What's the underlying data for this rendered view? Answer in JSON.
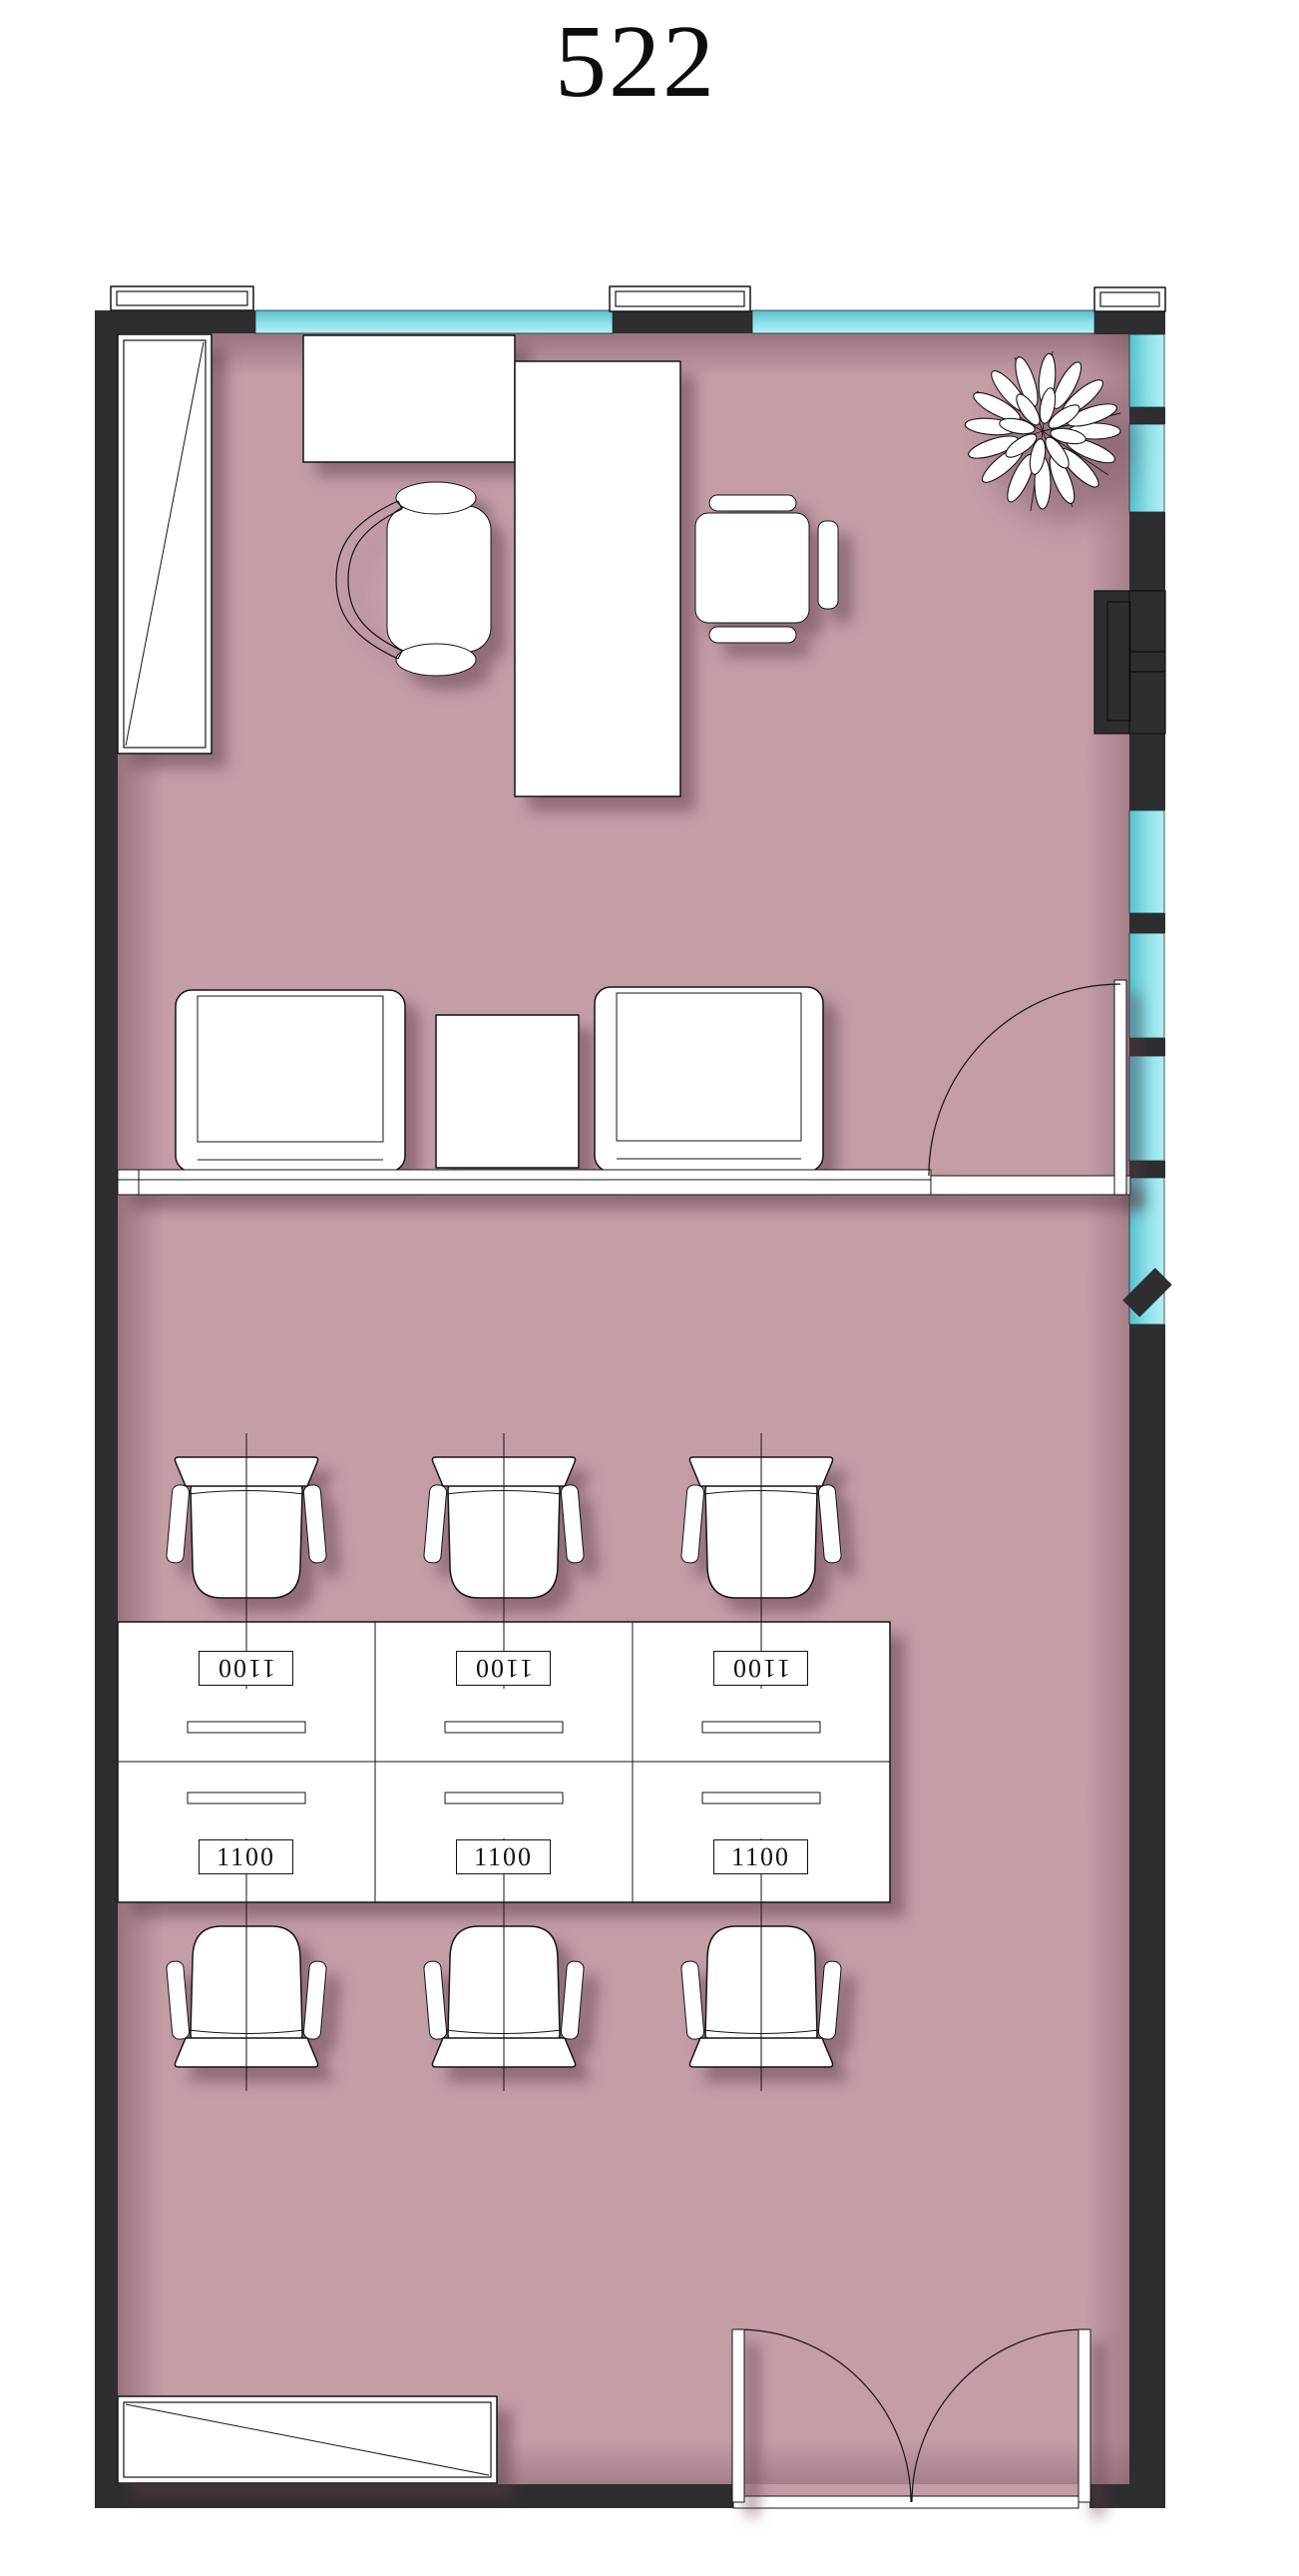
{
  "title": "522",
  "desk_grid": {
    "top_labels": [
      "1100",
      "1100",
      "1100"
    ],
    "bottom_labels": [
      "1100",
      "1100",
      "1100"
    ]
  },
  "colors": {
    "wall": "#2e2e30",
    "window_glass": "#7edbe4",
    "floor": "#c49da7",
    "furniture": "#ffffff",
    "line": "#141414",
    "paper": "#ffffff"
  }
}
